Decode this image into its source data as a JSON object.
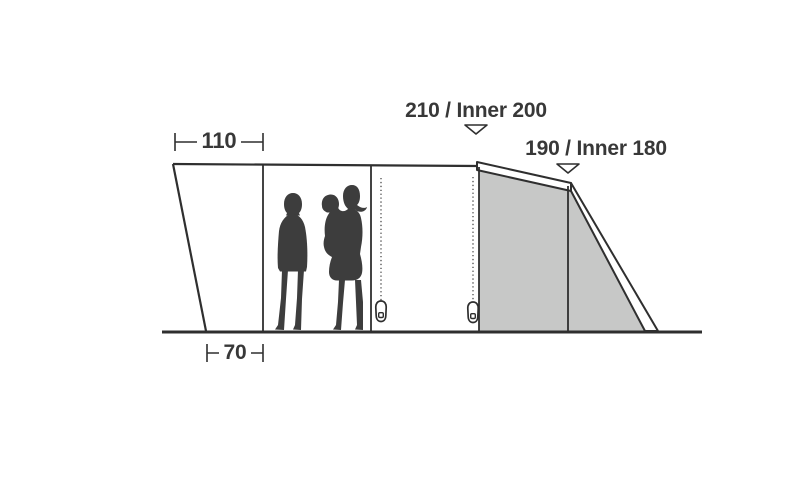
{
  "labels": {
    "width_top": "110",
    "width_bottom": "70",
    "height_main": "210 / Inner 200",
    "height_rear": "190 / Inner 180"
  },
  "colors": {
    "background": "#ffffff",
    "line": "#2f2f2f",
    "panel_fill": "#c7c8c7",
    "silhouette": "#3d3d3d",
    "text": "#383838"
  },
  "icons": {
    "height_marker": "triangle-down-icon",
    "zipper_pull": "zipper-pull-icon",
    "people": "family-silhouette-icon"
  }
}
